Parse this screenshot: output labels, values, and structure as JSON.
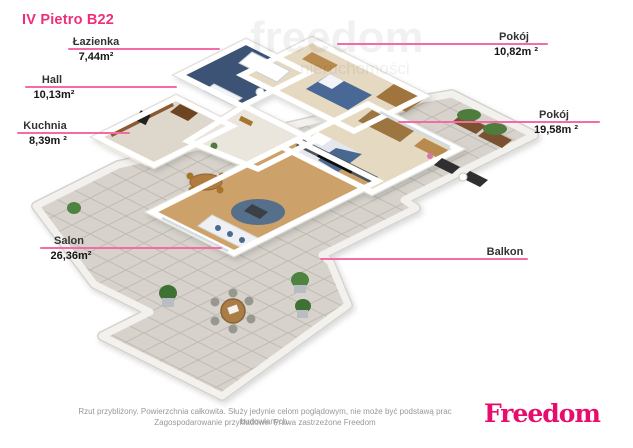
{
  "title": "IV Pietro B22",
  "watermark": {
    "big": "freedom",
    "small": "nieruchomości"
  },
  "labels": [
    {
      "id": "lazienka",
      "name": "Łazienka",
      "value": "7,44m²"
    },
    {
      "id": "hall",
      "name": "Hall",
      "value": "10,13m²"
    },
    {
      "id": "kuchnia",
      "name": "Kuchnia",
      "value": "8,39m ²"
    },
    {
      "id": "salon",
      "name": "Salon",
      "value": "26,36m²"
    },
    {
      "id": "pokoj-1",
      "name": "Pokój",
      "value": "10,82m ²"
    },
    {
      "id": "pokoj-2",
      "name": "Pokój",
      "value": "19,58m ²"
    },
    {
      "id": "balkon",
      "name": "Balkon",
      "value": ""
    }
  ],
  "footer": {
    "disclaimer_line1": "Rzut przybliżony. Powierzchnia całkowita. Służy jedynie celom poglądowym, nie może być podstawą prac budowlanych.",
    "disclaimer_line2": "Zagospodarowanie przykładowe. Prawa zastrzeżone Freedom",
    "logo": "Freedom"
  },
  "colors": {
    "accent_pink": "#ee2d7b",
    "label_line_pink": "#f46ba6",
    "logo_pink": "#e80c6c",
    "bathroom_navy": "#3c5375",
    "wood_floor": "#cda26a",
    "tile_gray": "#d7d3cc"
  }
}
